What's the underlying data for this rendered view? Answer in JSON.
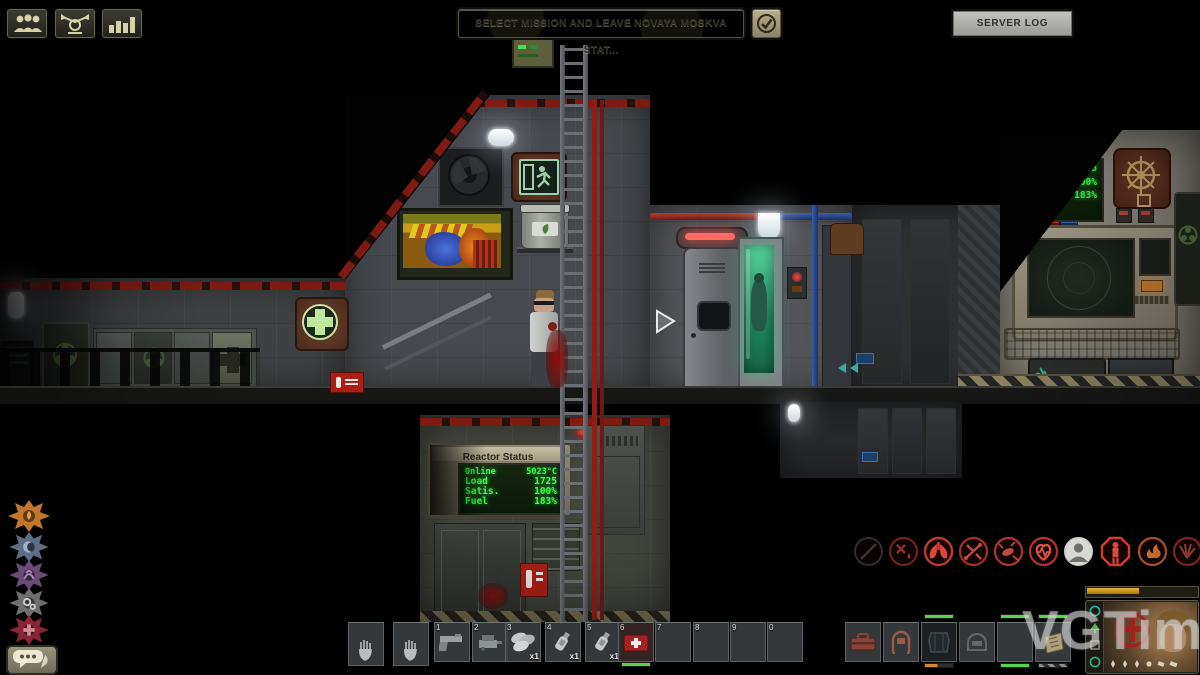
{
  "palette": {
    "hud_khaki": "#b3a97f",
    "hud_gray": "#b9bab6",
    "lcd_green": "#3aff4e",
    "xp_gold": "#c8930e",
    "alert_red": "#b32020",
    "condition_green": "#56d34f",
    "condition_orange": "#d98a2b"
  },
  "hud": {
    "top_left_buttons": [
      {
        "name": "crew-list",
        "icon": "crew-icon"
      },
      {
        "name": "chat-orders",
        "icon": "command-icon"
      },
      {
        "name": "mission-stats",
        "icon": "stats-icon"
      }
    ],
    "mission_button_label": "SELECT MISSION AND LEAVE NOVAYA MOSKVA STAT...",
    "ready_check_icon": "checkmark-icon",
    "server_log_label": "SERVER LOG",
    "watermark": "VGTimes"
  },
  "reactor_panel": {
    "title": "Reactor Status",
    "rows": [
      {
        "label": "Online",
        "value": "5023°C"
      },
      {
        "label": "Load",
        "value": "1725"
      },
      {
        "label": "Satis.",
        "value": "100%"
      },
      {
        "label": "Fuel",
        "value": "183%"
      }
    ]
  },
  "nav_screen": {
    "rows": [
      {
        "label": "",
        "value": "1725"
      },
      {
        "label": "Satis.",
        "value": "100%"
      },
      {
        "label": "Fuel",
        "value": "183%"
      }
    ]
  },
  "sigils": [
    {
      "name": "flame-sigil",
      "color": "#c1762a"
    },
    {
      "name": "moon-sigil",
      "color": "#5d6d85"
    },
    {
      "name": "tentacle-sigil",
      "color": "#6b4a78"
    },
    {
      "name": "gears-sigil",
      "color": "#6f6f6f"
    },
    {
      "name": "medic-sigil",
      "color": "#8a2437"
    }
  ],
  "afflictions": [
    {
      "name": "gunshot",
      "color": "#4a3838"
    },
    {
      "name": "bleeding",
      "color": "#77251f"
    },
    {
      "name": "oxygen-low",
      "color": "#c23a2e"
    },
    {
      "name": "fracture",
      "color": "#a33028"
    },
    {
      "name": "blood-loss",
      "color": "#b03430"
    },
    {
      "name": "heart-rate",
      "color": "#b03430"
    },
    {
      "name": "character",
      "color": "#cfcfcf"
    },
    {
      "name": "stun",
      "color": "#cc3f33"
    },
    {
      "name": "burn",
      "color": "#a8502a"
    },
    {
      "name": "paralysis",
      "color": "#7c241f"
    }
  ],
  "inventory": {
    "numbered_slots": [
      {
        "num": "1",
        "item": "pistol"
      },
      {
        "num": "2",
        "item": "welding-tool"
      },
      {
        "num": "3",
        "item": "tank-bundle",
        "count": "x1"
      },
      {
        "num": "4",
        "item": "bottle",
        "count": "x1"
      },
      {
        "num": "5",
        "item": "bottle",
        "count": "x1"
      },
      {
        "num": "6",
        "item": "medkit"
      },
      {
        "num": "7",
        "item": ""
      },
      {
        "num": "8",
        "item": ""
      },
      {
        "num": "9",
        "item": ""
      },
      {
        "num": "0",
        "item": ""
      }
    ],
    "equipment_slots": [
      {
        "item": "toolbox"
      },
      {
        "item": "diving-mask"
      },
      {
        "item": "body-armor",
        "bar_top": "green",
        "bar_bottom": "orange"
      },
      {
        "item": "helmet-ghost"
      },
      {
        "item": "empty",
        "bar_top": "green",
        "bar_bottom": "green"
      },
      {
        "item": "circuit-bag",
        "bar_top": "green",
        "bar_bottom": "hazard"
      }
    ]
  }
}
